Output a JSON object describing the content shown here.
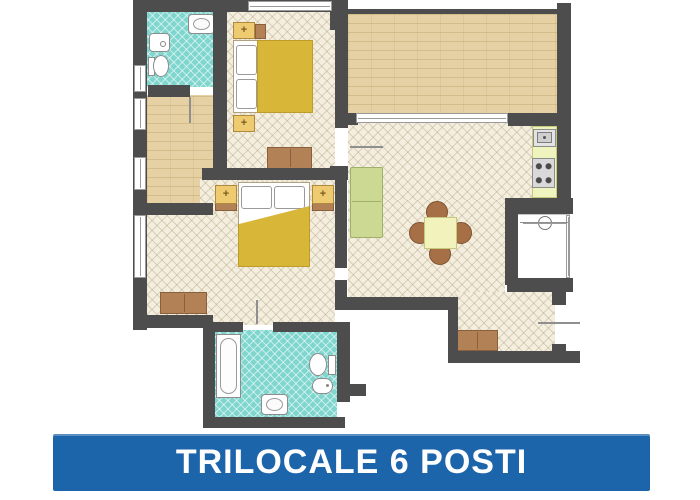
{
  "banner": {
    "label": "TRILOCALE 6 POSTI",
    "x": 53,
    "y": 434,
    "w": 597,
    "h": 57
  },
  "palette": {
    "wall": "#4d4d4d",
    "tile": "#f4eedf",
    "tile_line": "rgba(158,138,98,0.30)",
    "bath": "#7fd6ce",
    "bath_line": "rgba(255,255,255,0.55)",
    "terrace": "#e6d1a4",
    "terrace_line": "rgba(166,134,74,0.28)",
    "blanket": "#d8b637",
    "nightstand": "#eecb70",
    "nightstand_border": "#b08a3c",
    "wood": "#b28156",
    "wood_border": "#8a5f3c",
    "sofa": "#cbd992",
    "sofa_border": "#9fb069",
    "table": "#f2f3bc",
    "table_border": "#c6c97c",
    "chair": "#a76f45",
    "chair_border": "#7c5330",
    "counter": "#eff3bd",
    "fixture": "#8c8c8c",
    "banner_bg": "#1d65ab",
    "banner_text": "#ffffff"
  },
  "floorplan": {
    "rooms": [
      {
        "name": "bathroom-1-floor",
        "pattern": "bath",
        "x": 147,
        "y": 12,
        "w": 66,
        "h": 75
      },
      {
        "name": "hallway-floor",
        "pattern": "terrace",
        "x": 147,
        "y": 95,
        "w": 66,
        "h": 110
      },
      {
        "name": "bedroom-1-floor",
        "pattern": "tile",
        "x": 227,
        "y": 12,
        "w": 108,
        "h": 158
      },
      {
        "name": "terrace-floor",
        "pattern": "terrace",
        "x": 348,
        "y": 14,
        "w": 209,
        "h": 100
      },
      {
        "name": "living-floor-upper",
        "pattern": "tile",
        "x": 348,
        "y": 122,
        "w": 209,
        "h": 80
      },
      {
        "name": "living-floor-mid",
        "pattern": "tile",
        "x": 348,
        "y": 200,
        "w": 157,
        "h": 100
      },
      {
        "name": "living-floor-alcove",
        "pattern": "tile",
        "x": 455,
        "y": 292,
        "w": 100,
        "h": 62
      },
      {
        "name": "bedroom-2-floor-upper",
        "pattern": "tile",
        "x": 200,
        "y": 178,
        "w": 135,
        "h": 40
      },
      {
        "name": "bedroom-2-floor",
        "pattern": "tile",
        "x": 147,
        "y": 215,
        "w": 188,
        "h": 110
      },
      {
        "name": "bathroom-2-floor",
        "pattern": "bath",
        "x": 213,
        "y": 330,
        "w": 124,
        "h": 90
      },
      {
        "name": "loggia-floor",
        "pattern": "white",
        "x": 516,
        "y": 214,
        "w": 54,
        "h": 66
      }
    ],
    "furniture": [
      {
        "name": "bed1-base",
        "kind": "bed-base",
        "x": 233,
        "y": 40,
        "w": 80,
        "h": 73
      },
      {
        "name": "bed1-pillow-1",
        "kind": "pillow",
        "x": 236,
        "y": 45,
        "w": 21,
        "h": 30
      },
      {
        "name": "bed1-pillow-2",
        "kind": "pillow",
        "x": 236,
        "y": 79,
        "w": 21,
        "h": 30
      },
      {
        "name": "bed1-blanket",
        "kind": "blanket",
        "x": 257,
        "y": 40,
        "w": 56,
        "h": 73
      },
      {
        "name": "bed1-nightstand-top",
        "kind": "nightstand",
        "x": 233,
        "y": 22,
        "w": 22,
        "h": 17
      },
      {
        "name": "bed1-nightstand-side",
        "kind": "wood",
        "x": 255,
        "y": 24,
        "w": 11,
        "h": 15
      },
      {
        "name": "bed1-nightstand-bottom",
        "kind": "nightstand",
        "x": 233,
        "y": 115,
        "w": 22,
        "h": 17
      },
      {
        "name": "bed1-dresser",
        "kind": "dresser",
        "x": 267,
        "y": 147,
        "w": 45,
        "h": 22
      },
      {
        "name": "bed2-nightstand-left-shelf",
        "kind": "wood",
        "x": 215,
        "y": 203,
        "w": 22,
        "h": 8
      },
      {
        "name": "bed2-nightstand-right-shelf",
        "kind": "wood",
        "x": 312,
        "y": 203,
        "w": 22,
        "h": 8
      },
      {
        "name": "bed2-base",
        "kind": "bed-base",
        "x": 238,
        "y": 182,
        "w": 72,
        "h": 85
      },
      {
        "name": "bed2-pillow-1",
        "kind": "pillow",
        "x": 241,
        "y": 186,
        "w": 31,
        "h": 23
      },
      {
        "name": "bed2-pillow-2",
        "kind": "pillow",
        "x": 274,
        "y": 186,
        "w": 31,
        "h": 23
      },
      {
        "name": "bed2-blanket",
        "kind": "blanket",
        "x": 238,
        "y": 206,
        "w": 72,
        "h": 61,
        "clip": "polygon(0 30%, 100% 0, 100% 100%, 0 100%)"
      },
      {
        "name": "bed2-nightstand-left",
        "kind": "nightstand",
        "x": 215,
        "y": 185,
        "w": 22,
        "h": 19
      },
      {
        "name": "bed2-nightstand-right",
        "kind": "nightstand",
        "x": 312,
        "y": 185,
        "w": 22,
        "h": 19
      },
      {
        "name": "bed2-dresser",
        "kind": "dresser",
        "x": 160,
        "y": 292,
        "w": 47,
        "h": 22
      },
      {
        "name": "sofa",
        "kind": "sofa",
        "x": 350,
        "y": 167,
        "w": 33,
        "h": 71
      },
      {
        "name": "dining-chair-top",
        "kind": "chair",
        "x": 426,
        "y": 201,
        "w": 22,
        "h": 22
      },
      {
        "name": "dining-chair-bottom",
        "kind": "chair",
        "x": 429,
        "y": 243,
        "w": 22,
        "h": 22
      },
      {
        "name": "dining-chair-left",
        "kind": "chair",
        "x": 409,
        "y": 222,
        "w": 22,
        "h": 22
      },
      {
        "name": "dining-chair-right",
        "kind": "chair",
        "x": 450,
        "y": 222,
        "w": 22,
        "h": 22
      },
      {
        "name": "dining-table",
        "kind": "table",
        "x": 424,
        "y": 217,
        "w": 33,
        "h": 32
      },
      {
        "name": "kitchen-counter",
        "kind": "counter",
        "x": 532,
        "y": 126,
        "w": 25,
        "h": 72
      },
      {
        "name": "kitchen-sink",
        "kind": "ksink",
        "x": 533,
        "y": 129,
        "w": 23,
        "h": 18
      },
      {
        "name": "kitchen-stove",
        "kind": "stove",
        "x": 532,
        "y": 158,
        "w": 23,
        "h": 30
      },
      {
        "name": "entry-cabinet",
        "kind": "dresser",
        "x": 456,
        "y": 330,
        "w": 42,
        "h": 21
      },
      {
        "name": "bath1-sink",
        "kind": "bsink",
        "x": 188,
        "y": 14,
        "w": 27,
        "h": 20
      },
      {
        "name": "bath1-washer",
        "kind": "washer",
        "x": 149,
        "y": 33,
        "w": 21,
        "h": 19
      },
      {
        "name": "bath1-toilet-tank",
        "kind": "toilet-tank",
        "x": 148,
        "y": 57,
        "w": 7,
        "h": 19
      },
      {
        "name": "bath1-toilet-bowl",
        "kind": "toilet-bowl",
        "x": 153,
        "y": 55,
        "w": 16,
        "h": 22
      },
      {
        "name": "bath2-tub",
        "kind": "tub",
        "x": 216,
        "y": 334,
        "w": 25,
        "h": 64
      },
      {
        "name": "bath2-toilet-tank",
        "kind": "toilet-tank",
        "x": 328,
        "y": 355,
        "w": 8,
        "h": 20
      },
      {
        "name": "bath2-toilet-bowl",
        "kind": "toilet-bowl",
        "x": 309,
        "y": 353,
        "w": 18,
        "h": 23
      },
      {
        "name": "bath2-bidet",
        "kind": "bidet",
        "x": 312,
        "y": 378,
        "w": 21,
        "h": 16
      },
      {
        "name": "bath2-sink",
        "kind": "bsink",
        "x": 261,
        "y": 394,
        "w": 27,
        "h": 21
      },
      {
        "name": "loggia-washbasin",
        "kind": "lsink",
        "x": 531,
        "y": 214,
        "w": 28,
        "h": 18
      }
    ],
    "walls": [
      {
        "name": "wall-top",
        "x": 133,
        "y": 0,
        "w": 215,
        "h": 12
      },
      {
        "name": "wall-left",
        "x": 133,
        "y": 12,
        "w": 14,
        "h": 318
      },
      {
        "name": "wall-bath1-bottom",
        "x": 148,
        "y": 85,
        "w": 42,
        "h": 12
      },
      {
        "name": "wall-bed1-left",
        "x": 213,
        "y": 0,
        "w": 14,
        "h": 170
      },
      {
        "name": "wall-hall-bottom",
        "x": 133,
        "y": 203,
        "w": 80,
        "h": 12
      },
      {
        "name": "wall-bedroom-divider",
        "x": 202,
        "y": 168,
        "w": 143,
        "h": 12
      },
      {
        "name": "wall-bed1-living",
        "x": 335,
        "y": 12,
        "w": 13,
        "h": 116
      },
      {
        "name": "wall-junction",
        "x": 330,
        "y": 166,
        "w": 18,
        "h": 14
      },
      {
        "name": "wall-bed2-living-a",
        "x": 335,
        "y": 180,
        "w": 12,
        "h": 88
      },
      {
        "name": "wall-bed2-living-b",
        "x": 335,
        "y": 280,
        "w": 12,
        "h": 30
      },
      {
        "name": "wall-living-bottom-left",
        "x": 337,
        "y": 297,
        "w": 121,
        "h": 13
      },
      {
        "name": "wall-step",
        "x": 448,
        "y": 305,
        "w": 10,
        "h": 58
      },
      {
        "name": "wall-living-bottom-right",
        "x": 448,
        "y": 351,
        "w": 118,
        "h": 12
      },
      {
        "name": "wall-right-door-top",
        "x": 552,
        "y": 292,
        "w": 14,
        "h": 13
      },
      {
        "name": "wall-right-door-bottom",
        "x": 552,
        "y": 344,
        "w": 14,
        "h": 19
      },
      {
        "name": "wall-entry-stub",
        "x": 566,
        "y": 351,
        "w": 14,
        "h": 12
      },
      {
        "name": "wall-loggia-bottom",
        "x": 507,
        "y": 278,
        "w": 66,
        "h": 14
      },
      {
        "name": "wall-loggia-left",
        "x": 505,
        "y": 213,
        "w": 13,
        "h": 72
      },
      {
        "name": "wall-kitchen-divider",
        "x": 505,
        "y": 198,
        "w": 68,
        "h": 16
      },
      {
        "name": "wall-right-outer",
        "x": 557,
        "y": 3,
        "w": 14,
        "h": 203
      },
      {
        "name": "terrace-railing",
        "x": 348,
        "y": 9,
        "w": 209,
        "h": 5
      },
      {
        "name": "terrace-pillar-left",
        "x": 330,
        "y": 6,
        "w": 18,
        "h": 24
      },
      {
        "name": "wall-terrace-living-right",
        "x": 508,
        "y": 113,
        "w": 49,
        "h": 13
      },
      {
        "name": "wall-terrace-living-left",
        "x": 348,
        "y": 113,
        "w": 10,
        "h": 12
      },
      {
        "name": "wall-bed2-bottom",
        "x": 133,
        "y": 315,
        "w": 80,
        "h": 13
      },
      {
        "name": "wall-bath2-top-left",
        "x": 213,
        "y": 322,
        "w": 30,
        "h": 10
      },
      {
        "name": "wall-bath2-top-right",
        "x": 273,
        "y": 322,
        "w": 64,
        "h": 10
      },
      {
        "name": "wall-bath2-left",
        "x": 203,
        "y": 328,
        "w": 12,
        "h": 92
      },
      {
        "name": "wall-bath2-right",
        "x": 337,
        "y": 322,
        "w": 13,
        "h": 80
      },
      {
        "name": "wall-bath2-stub",
        "x": 350,
        "y": 384,
        "w": 16,
        "h": 12
      },
      {
        "name": "wall-bath2-bottom",
        "x": 203,
        "y": 417,
        "w": 142,
        "h": 11
      }
    ],
    "windows": [
      {
        "name": "window-bed1-top",
        "x": 248,
        "y": 1,
        "w": 84,
        "h": 10,
        "orient": "h"
      },
      {
        "name": "window-bath1",
        "x": 134,
        "y": 65,
        "w": 12,
        "h": 27,
        "orient": "v"
      },
      {
        "name": "window-hall-1",
        "x": 134,
        "y": 98,
        "w": 12,
        "h": 32,
        "orient": "v"
      },
      {
        "name": "window-hall-2",
        "x": 134,
        "y": 157,
        "w": 12,
        "h": 33,
        "orient": "v"
      },
      {
        "name": "window-bed2",
        "x": 134,
        "y": 215,
        "w": 12,
        "h": 63,
        "orient": "v"
      },
      {
        "name": "window-terrace-door",
        "x": 356,
        "y": 113,
        "w": 152,
        "h": 10,
        "orient": "h"
      },
      {
        "name": "window-loggia-edge",
        "x": 566,
        "y": 215,
        "w": 4,
        "h": 63,
        "orient": "v"
      }
    ],
    "doors": [
      {
        "name": "door-bath1-leaf",
        "x": 189,
        "y": 97,
        "w": 2,
        "h": 26
      },
      {
        "name": "door-bed1-leaf",
        "x": 350,
        "y": 146,
        "w": 33,
        "h": 2
      },
      {
        "name": "door-bath2-leaf",
        "x": 256,
        "y": 300,
        "w": 2,
        "h": 24
      },
      {
        "name": "door-entrance-leaf",
        "x": 538,
        "y": 322,
        "w": 42,
        "h": 2
      },
      {
        "name": "loggia-dim-line",
        "x": 520,
        "y": 222,
        "w": 48,
        "h": 1
      }
    ]
  }
}
